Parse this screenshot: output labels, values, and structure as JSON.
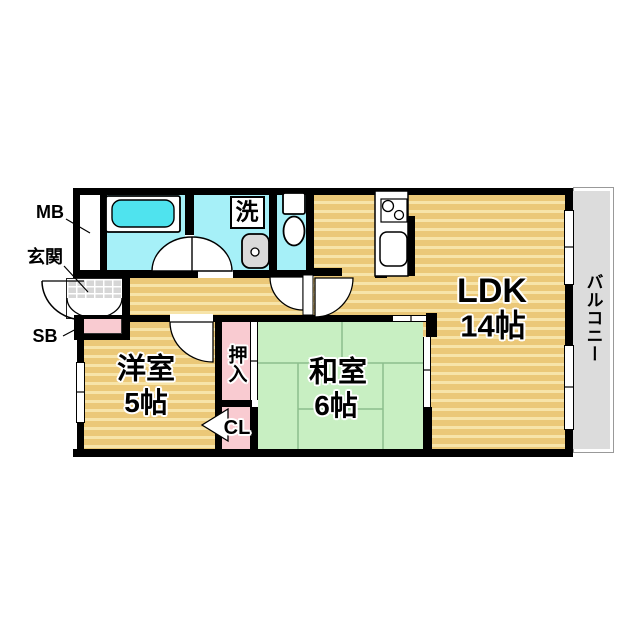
{
  "diagram": {
    "type": "apartment-floor-plan",
    "layout_style": "2LDK"
  },
  "labels": {
    "meter_box": "MB",
    "entrance": "玄関",
    "shoe_box": "SB",
    "laundry": "洗",
    "ldk_name": "LDK",
    "ldk_size": "14帖",
    "western_room_name": "洋室",
    "western_room_size": "5帖",
    "japanese_room_name": "和室",
    "japanese_room_size": "6帖",
    "oshiire": "押入",
    "closet": "CL",
    "balcony": "バルコニー"
  },
  "colors": {
    "wall": "#000000",
    "wood_floor": "#EBC878",
    "wood_floor_stripe": "#F7E4A9",
    "tatami": "#C8EFC2",
    "tatami_line": "#8CBE8C",
    "wet_area": "#A6F0F8",
    "bathtub": "#4FE3EE",
    "storage_pink": "#F9CBD1",
    "entrance_tile": "#D6D6D6",
    "balcony": "#DCDCDC"
  }
}
